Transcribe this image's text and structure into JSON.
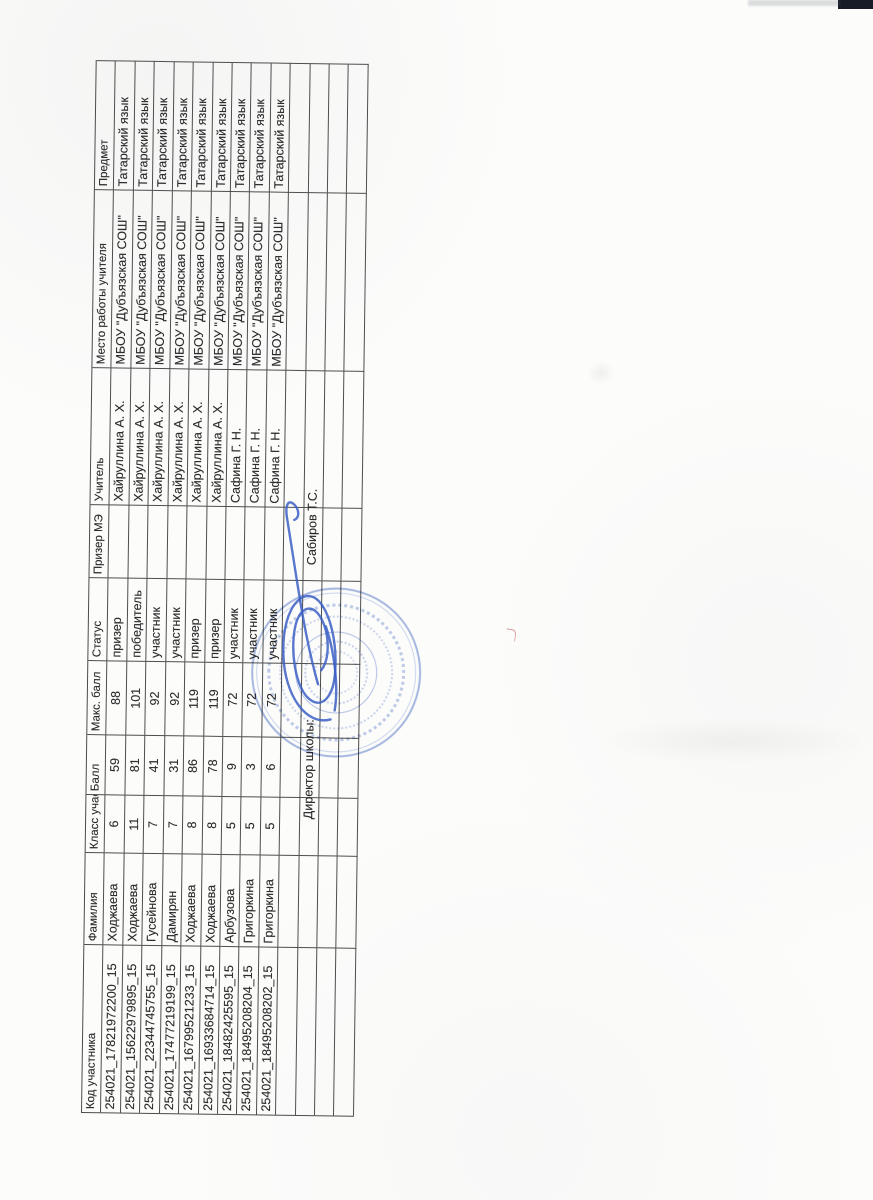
{
  "colors": {
    "paper": "#fcfcfb",
    "ink": "#2b2b2b",
    "grid_line": "#4e4e4e",
    "stamp_blue": "#5676c6",
    "signature_blue": "#3b5fc4"
  },
  "table": {
    "headers": [
      "Код участника",
      "Фамилия",
      "Класс учас",
      "Балл",
      "Макс. балл",
      "Статус",
      "Призер МЭ",
      "Учитель",
      "Место работы учителя",
      "Предмет"
    ],
    "rows": [
      [
        "254021_17821972200_15",
        "Ходжаева",
        "6",
        "59",
        "88",
        "призер",
        "",
        "Хайруллина А. Х.",
        "МБОУ \"Дубъязская СОШ\"",
        "Татарский язык"
      ],
      [
        "254021_15622979895_15",
        "Ходжаева",
        "11",
        "81",
        "101",
        "победитель",
        "",
        "Хайруллина А. Х.",
        "МБОУ \"Дубъязская СОШ\"",
        "Татарский язык"
      ],
      [
        "254021_22344745755_15",
        "Гусейнова",
        "7",
        "41",
        "92",
        "участник",
        "",
        "Хайруллина А. Х.",
        "МБОУ \"Дубъязская СОШ\"",
        "Татарский язык"
      ],
      [
        "254021_17477219199_15",
        "Дамирян",
        "7",
        "31",
        "92",
        "участник",
        "",
        "Хайруллина А. Х.",
        "МБОУ \"Дубъязская СОШ\"",
        "Татарский язык"
      ],
      [
        "254021_16799521233_15",
        "Ходжаева",
        "8",
        "86",
        "119",
        "призер",
        "",
        "Хайруллина А. Х.",
        "МБОУ \"Дубъязская СОШ\"",
        "Татарский язык"
      ],
      [
        "254021_16933684714_15",
        "Ходжаева",
        "8",
        "78",
        "119",
        "призер",
        "",
        "Хайруллина А. Х.",
        "МБОУ \"Дубъязская СОШ\"",
        "Татарский язык"
      ],
      [
        "254021_18482425595_15",
        "Арбузова",
        "5",
        "9",
        "72",
        "участник",
        "",
        "Сафина Г. Н.",
        "МБОУ \"Дубъязская СОШ\"",
        "Татарский язык"
      ],
      [
        "254021_18495208204_15",
        "Григоркина",
        "5",
        "3",
        "72",
        "участник",
        "",
        "Сафина Г. Н.",
        "МБОУ \"Дубъязская СОШ\"",
        "Татарский язык"
      ],
      [
        "254021_18495208202_15",
        "Григоркина",
        "5",
        "6",
        "72",
        "участник",
        "",
        "Сафина Г. Н.",
        "МБОУ \"Дубъязская СОШ\"",
        "Татарский язык"
      ]
    ]
  },
  "signature_block": {
    "director_label": "Директор школы:",
    "director_name": "Сабиров Т.С."
  }
}
